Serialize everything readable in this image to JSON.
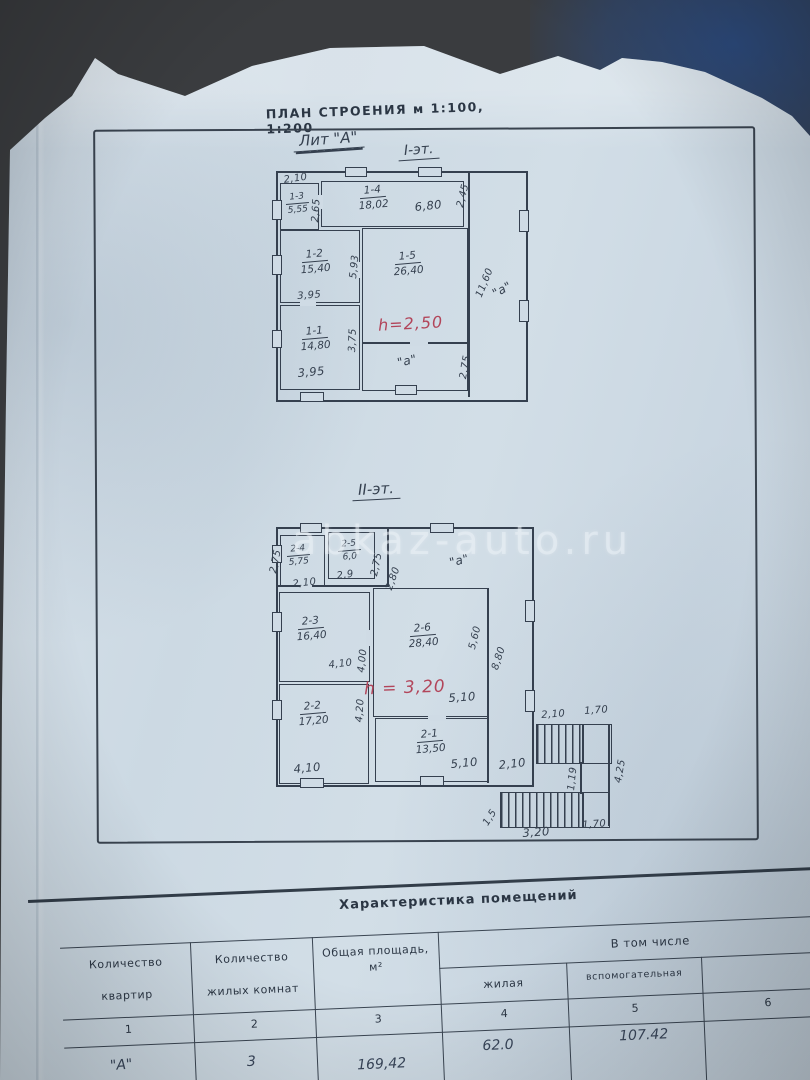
{
  "colors": {
    "paper": "#cfdbe5",
    "ink": "#35404f",
    "red_ink": "#b2455a",
    "photo_bg": "#3a3c3f",
    "blue_patch": "#2c4a7c"
  },
  "header": {
    "title": "ПЛАН СТРОЕНИЯ  м  1:100,  1:200"
  },
  "plan": {
    "liter": "Лит \"А\"",
    "floor1_label": "I-эт.",
    "floor2_label": "II-эт."
  },
  "watermark": "abkaz-auto.ru",
  "floor1": {
    "height_note": "h=2,50",
    "gallery_dim": "11,60",
    "gallery_label": "\"а\"",
    "annex_label": "\"а\"",
    "rooms": [
      {
        "id": "1-3",
        "area": "5,55"
      },
      {
        "id": "1-4",
        "area": "18,02"
      },
      {
        "id": "1-2",
        "area": "15,40"
      },
      {
        "id": "1-5",
        "area": "26,40"
      },
      {
        "id": "1-1",
        "area": "14,80"
      }
    ],
    "dims": {
      "d210": "2,10",
      "d265": "2,65",
      "d680": "6,80",
      "d245": "2,45",
      "d593": "5,93",
      "d395a": "3,95",
      "d375": "3,75",
      "d395b": "3,95",
      "d275": "2,75"
    }
  },
  "floor2": {
    "height_note": "h = 3,20",
    "porch_label": "\"а\"",
    "rooms": [
      {
        "id": "2-4",
        "area": "5,75"
      },
      {
        "id": "2-5",
        "area": "6,0"
      },
      {
        "id": "2-3",
        "area": "16,40"
      },
      {
        "id": "2-6",
        "area": "28,40"
      },
      {
        "id": "2-2",
        "area": "17,20"
      },
      {
        "id": "2-1",
        "area": "13,50"
      }
    ],
    "dims": {
      "d275l": "2,75",
      "d210": "2,10",
      "d29": "2,9",
      "d275r": "2,75",
      "d280": "2,80",
      "d410a": "4,10",
      "d400": "4,00",
      "d560": "5,60",
      "d880": "8,80",
      "d420": "4,20",
      "d410b": "4,10",
      "d510a": "5,10",
      "d510b": "5,10",
      "d210r": "2,10"
    },
    "stairs": {
      "top_w": "2,10",
      "top_right_w": "1,70",
      "right_h": "4,25",
      "mid_h": "1,19",
      "left_h": "1,5",
      "bottom_w": "3,20",
      "bottom_right_w": "1,70"
    }
  },
  "table": {
    "title": "Характеристика  помещений",
    "group_header": "В  том  числе",
    "col1_line1": "Количество",
    "col1_line2": "квартир",
    "col2_line1": "Количество",
    "col2_line2": "жилых комнат",
    "col3_line1": "Общая площадь,",
    "col3_line2": "м²",
    "col4": "жилая",
    "col5": "вспомогательная",
    "nums": [
      "1",
      "2",
      "3",
      "4",
      "5",
      "6"
    ],
    "row": {
      "c1": "\"А\"",
      "c2": "3",
      "c3": "169,42",
      "c4": "62.0",
      "c5": "107.42"
    }
  }
}
